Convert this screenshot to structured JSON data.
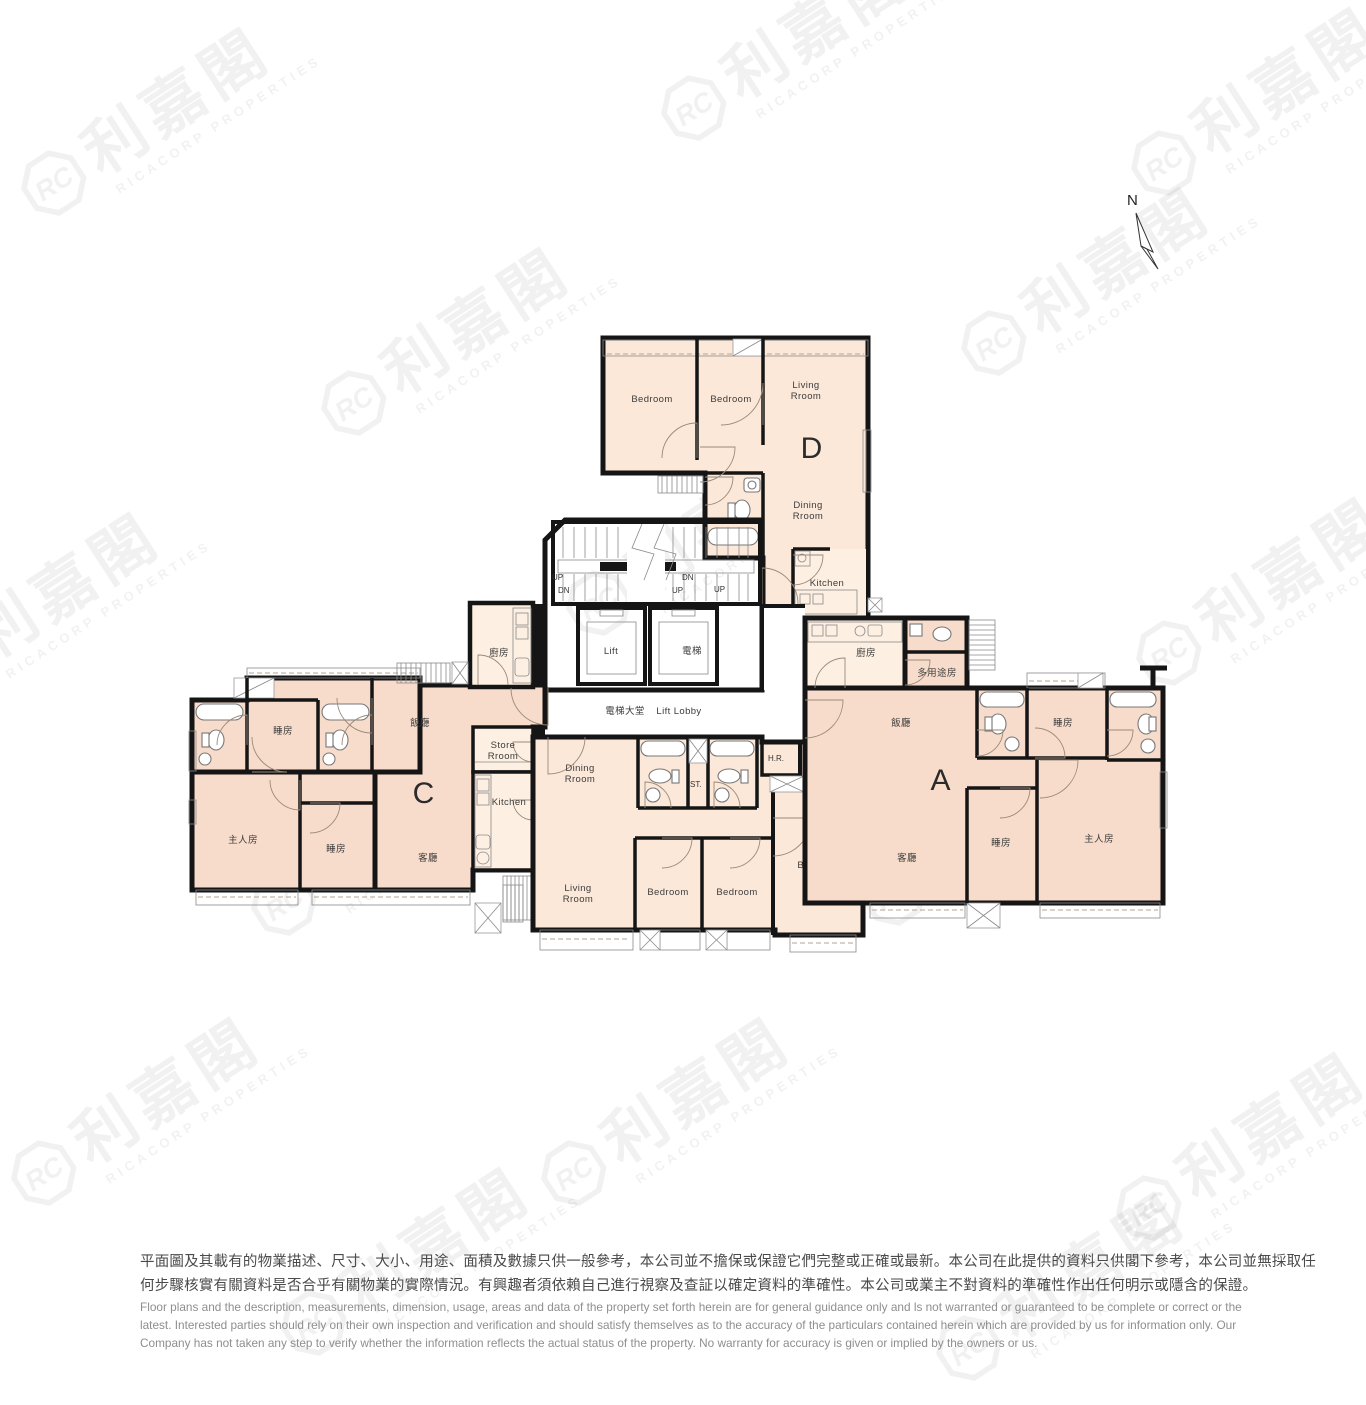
{
  "north": {
    "label": "N"
  },
  "watermark": {
    "logo": "RC",
    "cn": "利嘉閣",
    "en": "RICACORP PROPERTIES"
  },
  "core": {
    "lift_en": "Lift",
    "lift_cn": "電梯",
    "lobby_cn": "電梯大堂",
    "lobby_en": "Lift Lobby",
    "up": "UP",
    "dn": "DN"
  },
  "units": {
    "d": {
      "letter": "D",
      "bed1": "Bedroom",
      "bed2": "Bedroom",
      "living_l1": "Living",
      "living_l2": "Rroom",
      "dining_l1": "Dining",
      "dining_l2": "Rroom",
      "kitchen": "Kitchen"
    },
    "c": {
      "letter": "C",
      "bed_top": "睡房",
      "bed_bottom": "睡房",
      "master": "主人房",
      "dining": "飯廳",
      "living": "客廳",
      "kitchen_cn": "廚房",
      "store_l1": "Store",
      "store_l2": "Rroom",
      "kitchen_en": "Kitchen"
    },
    "b": {
      "letter": "B",
      "dining_l1": "Dining",
      "dining_l2": "Rroom",
      "living_l1": "Living",
      "living_l2": "Rroom",
      "bed1": "Bedroom",
      "bed2": "Bedroom",
      "master_l1": "Mester",
      "master_l2": "Bedroom",
      "st": "ST.",
      "hr": "H.R.",
      "meter_l1": "Meter",
      "meter_l2": "Room"
    },
    "a": {
      "letter": "A",
      "kitchen": "廚房",
      "multi": "多用途房",
      "dining": "飯廳",
      "living": "客廳",
      "bed_top": "睡房",
      "bed_bottom": "睡房",
      "master": "主人房"
    }
  },
  "disclaimer": {
    "zh1": "平面圖及其載有的物業描述、尺寸、大小、用途、面積及數據只供一般參考，本公司並不擔保或保證它們完整或正確或最新。本公司在此提供的資料只供閣下參考，本公司並無採取任",
    "zh2": "何步驟核實有關資料是否合乎有關物業的實際情況。有興趣者須依賴自己進行視察及查証以確定資料的準確性。本公司或業主不對資料的準確性作出任何明示或隱含的保證。",
    "en1": "Floor plans and the description, measurements, dimension, usage, areas and data of the property set forth herein are for general guidance only and ls not warranted or guaranteed to be complete or correct or the",
    "en2": "latest. Interested parties should rely on their own inspection and verification and should satisfy themselves as to the accuracy of the particulars contained herein which are provided by us for information only.  Our",
    "en3": "Company has not taken any step to verify whether the information reflects the actual status of the property.  No warranty for accuracy is given or implied by the owners or us."
  },
  "colors": {
    "unit_ac": "#f8dccb",
    "unit_bd": "#fbe8d9",
    "service": "#fdf0e2",
    "bay": "#fcf3e7",
    "wall": "#151515"
  }
}
